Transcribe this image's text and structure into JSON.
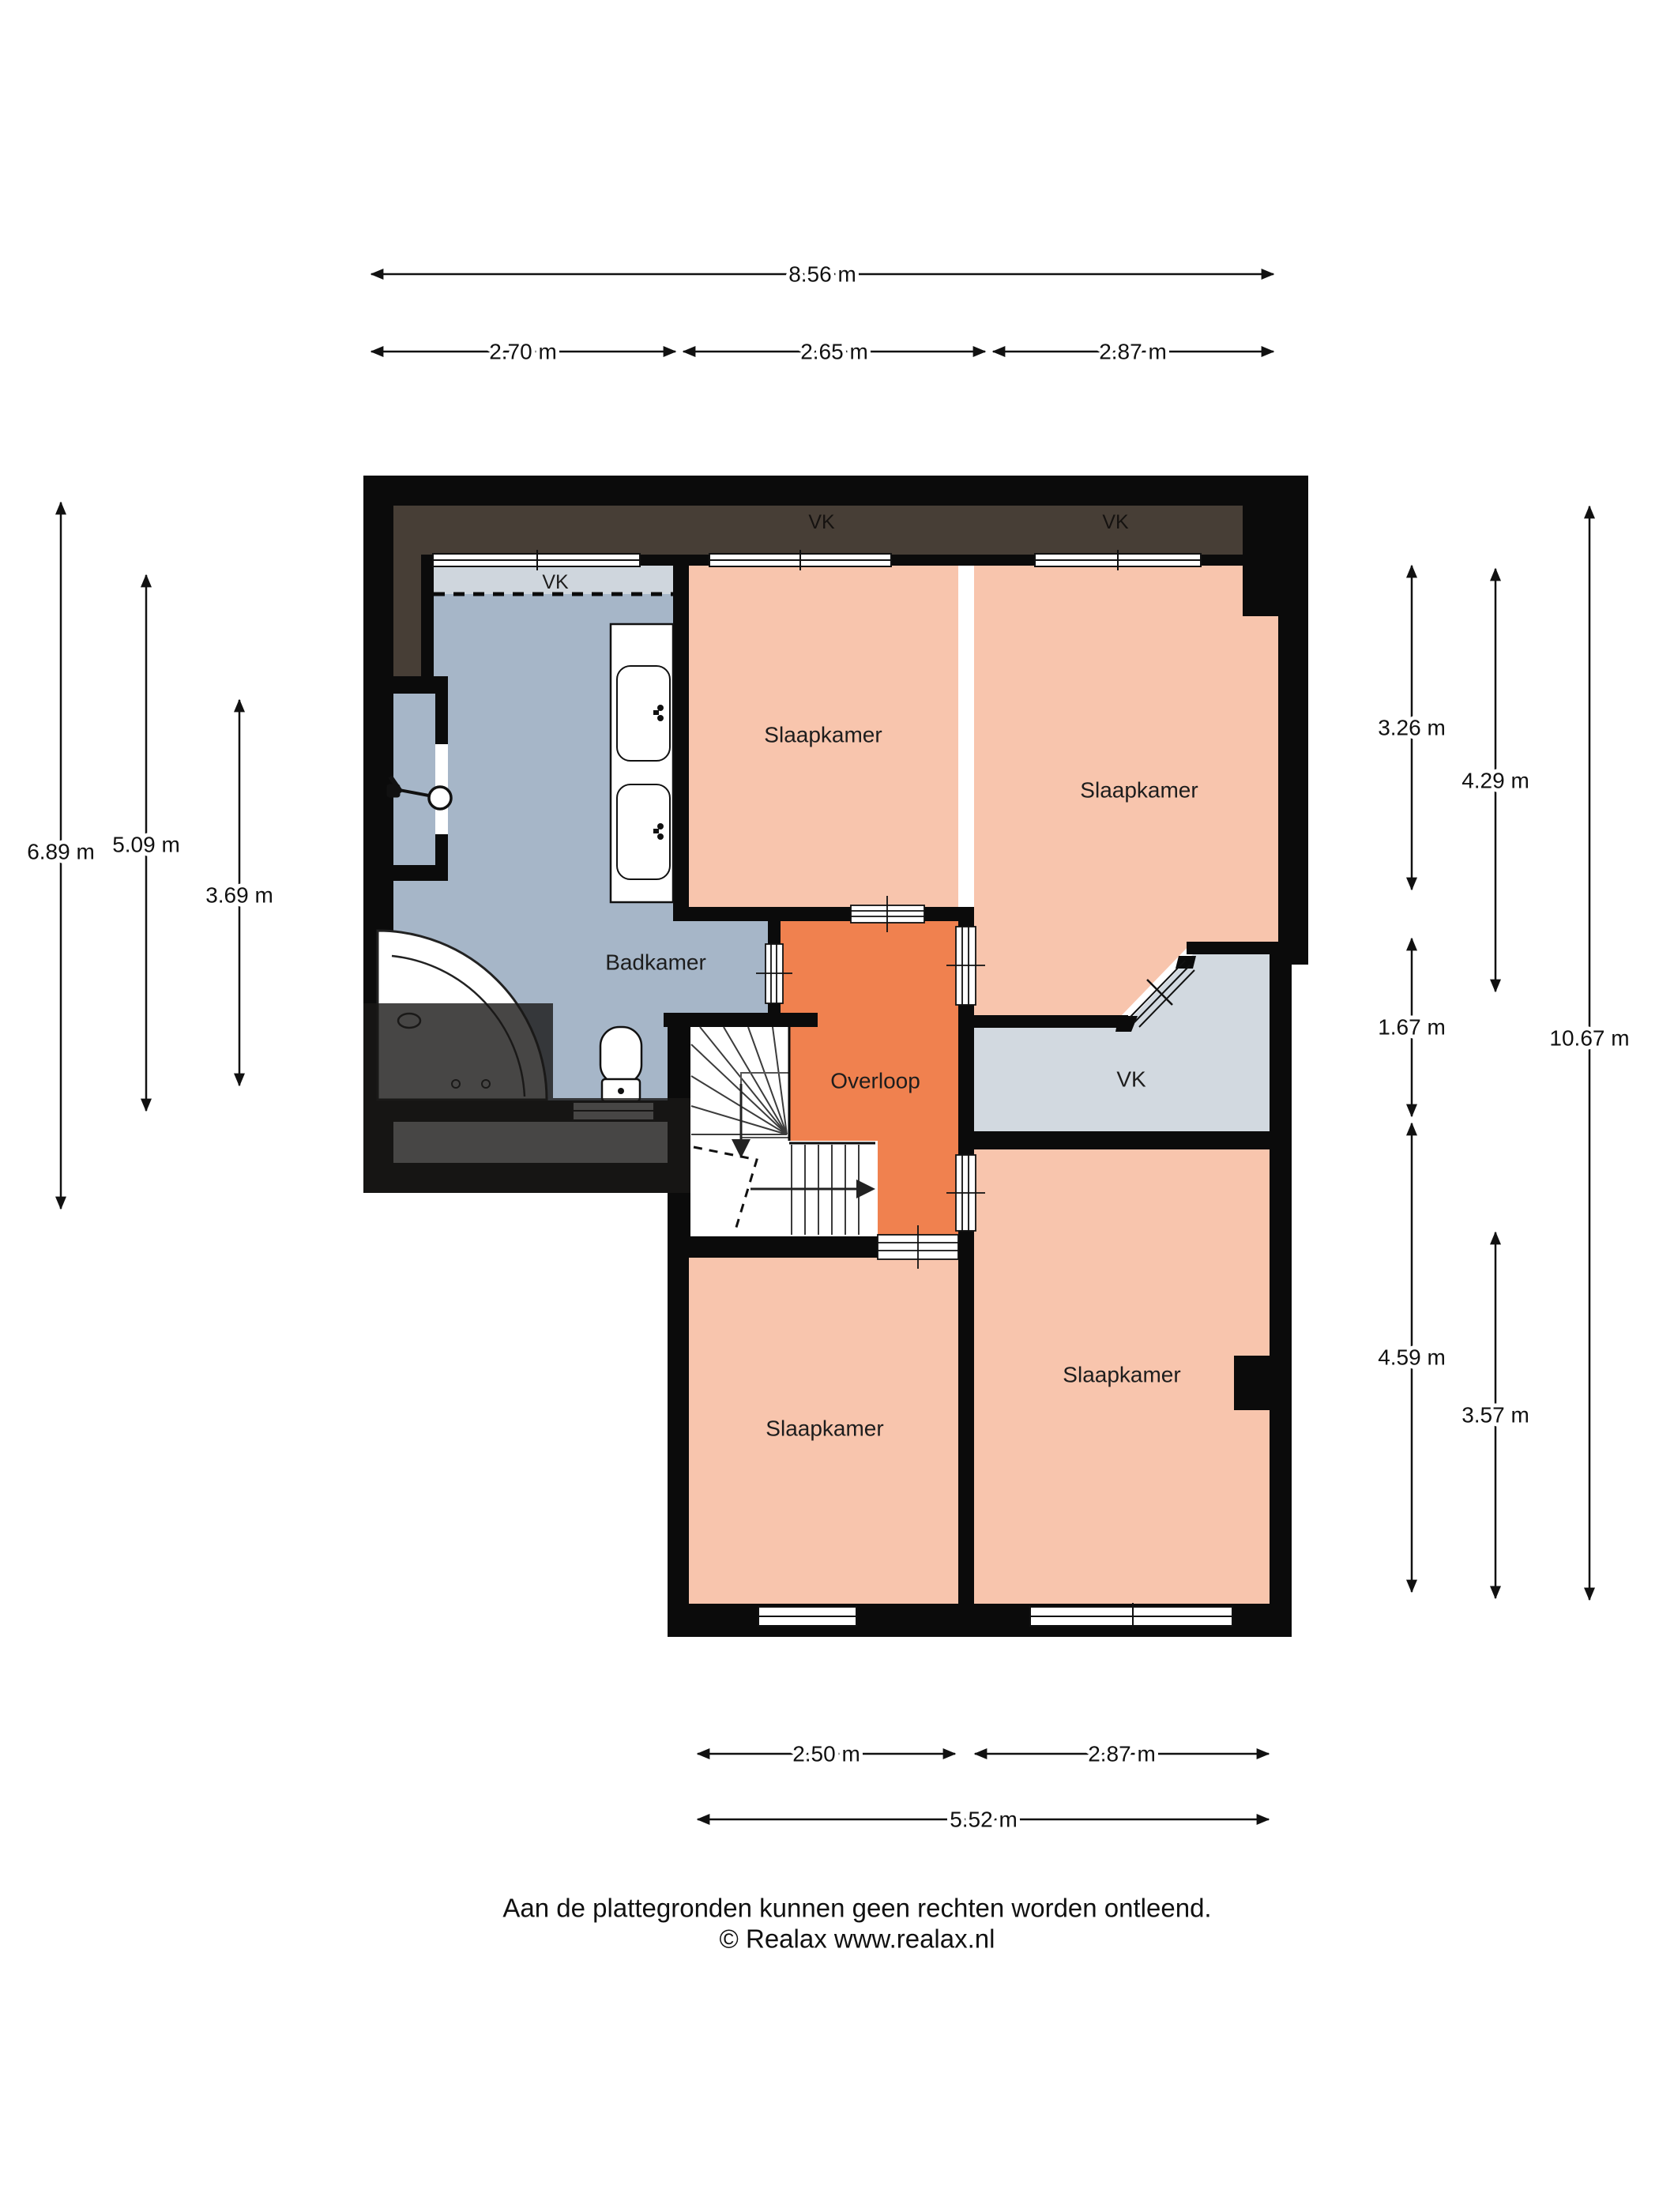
{
  "meta": {
    "type": "floorplan",
    "floor": "verdieping"
  },
  "colors": {
    "wall": "#0b0b0b",
    "bedroom": "#f8c5ad",
    "landing": "#f0814f",
    "bathroom": "#a6b6c8",
    "closet": "#d2d9e0",
    "closet_strip": "#cfd6dd",
    "attic": "#473e36",
    "fixture": "#ffffff",
    "overlay": "rgba(25,24,23,0.8)"
  },
  "rooms": {
    "bedroom_top_left": {
      "label": "Slaapkamer"
    },
    "bedroom_top_right": {
      "label": "Slaapkamer"
    },
    "bedroom_bottom_left": {
      "label": "Slaapkamer"
    },
    "bedroom_bottom_right": {
      "label": "Slaapkamer"
    },
    "bathroom": {
      "label": "Badkamer"
    },
    "landing": {
      "label": "Overloop"
    },
    "closet_right": {
      "label": "VK"
    },
    "closet_bathroom": {
      "label": "VK"
    },
    "closet_attic_1": {
      "label": "VK"
    },
    "closet_attic_2": {
      "label": "VK"
    }
  },
  "dimensions": {
    "top": [
      {
        "label": "8.56 m"
      },
      {
        "label": "2.70 m"
      },
      {
        "label": "2.65 m"
      },
      {
        "label": "2.87 m"
      }
    ],
    "left": [
      {
        "label": "6.89 m"
      },
      {
        "label": "5.09 m"
      },
      {
        "label": "3.69 m"
      }
    ],
    "right": [
      {
        "label": "3.26 m"
      },
      {
        "label": "4.29 m"
      },
      {
        "label": "1.67 m"
      },
      {
        "label": "10.67 m"
      },
      {
        "label": "4.59 m"
      },
      {
        "label": "3.57 m"
      }
    ],
    "bottom": [
      {
        "label": "2.50 m"
      },
      {
        "label": "2.87 m"
      },
      {
        "label": "5.52 m"
      }
    ]
  },
  "footer": {
    "line1": "Aan de plattegronden kunnen geen rechten worden ontleend.",
    "line2": "© Realax www.realax.nl"
  }
}
